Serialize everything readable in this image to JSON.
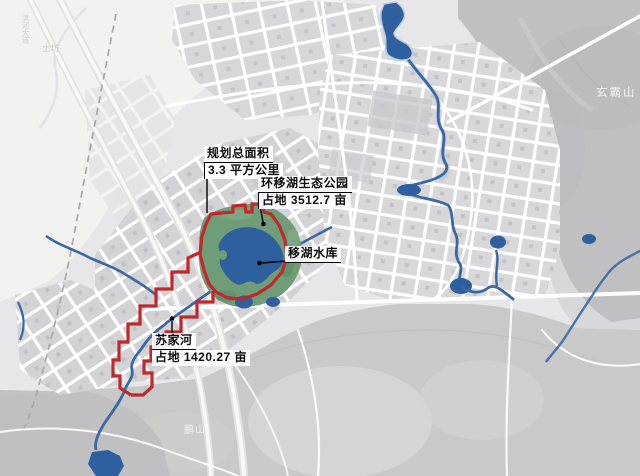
{
  "map": {
    "callouts": {
      "planning": {
        "title": "规划总面积",
        "value": "3.3 平方公里"
      },
      "eco_park": {
        "title": "环移湖生态公园",
        "value": "占地 3512.7 亩"
      },
      "reservoir": {
        "title": "移湖水库"
      },
      "sujia_river": {
        "title": "苏家河",
        "value": "占地 1420.27 亩"
      }
    },
    "place_labels": {
      "mountain_top_right": "玄霸山",
      "hill_bottom_left": "鹏山",
      "area_top_left": "土坊",
      "road_top_left": "滨河大道"
    },
    "colors": {
      "background": "#e7e7e9",
      "pale_area": "#f2f2f0",
      "block_gray": "#d6d6d9",
      "road_white": "#ffffff",
      "mountain_gray": "#c0c0c3",
      "hills_gray": "#c9c9c9",
      "water_fill": "#2e5f9f",
      "river_stroke": "#3a68a4",
      "park_green": "#6f9d78",
      "boundary_red": "#c1272b",
      "callout_text": "#0d0d0d"
    }
  }
}
